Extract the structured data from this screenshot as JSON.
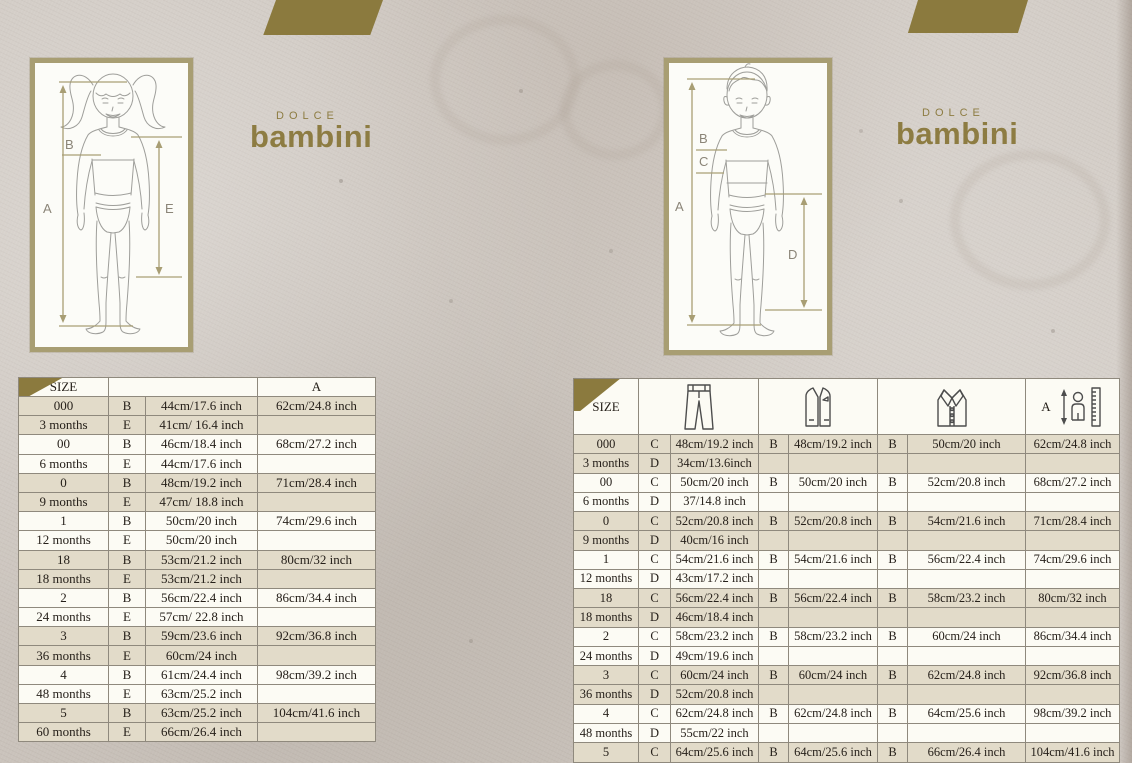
{
  "brand": {
    "dolce": "DOLCE",
    "bambini": "bambini"
  },
  "colors": {
    "gold_decoration": "#8b7a3e",
    "logo_gold": "#8d7c42",
    "row_beige": "#e2dbc9",
    "row_white": "#fcfbf4",
    "table_border": "#8f897d",
    "frame_tan": "#a89e73",
    "text": "#26201a",
    "background": "#cec7c0"
  },
  "girl_diagram": {
    "label_a": "A",
    "label_b": "B",
    "label_e": "E"
  },
  "boy_diagram": {
    "label_a": "A",
    "label_b": "B",
    "label_c": "C",
    "label_d": "D"
  },
  "left_table": {
    "header": {
      "size": "SIZE",
      "a": "A"
    },
    "rows": [
      [
        "000",
        "B",
        "44cm/17.6 inch",
        "62cm/24.8 inch"
      ],
      [
        "3 months",
        "E",
        "41cm/ 16.4 inch",
        ""
      ],
      [
        "00",
        "B",
        "46cm/18.4 inch",
        "68cm/27.2 inch"
      ],
      [
        "6 months",
        "E",
        "44cm/17.6 inch",
        ""
      ],
      [
        "0",
        "B",
        "48cm/19.2 inch",
        "71cm/28.4 inch"
      ],
      [
        "9 months",
        "E",
        "47cm/ 18.8 inch",
        ""
      ],
      [
        "1",
        "B",
        "50cm/20 inch",
        "74cm/29.6 inch"
      ],
      [
        "12 months",
        "E",
        "50cm/20 inch",
        ""
      ],
      [
        "18",
        "B",
        "53cm/21.2 inch",
        "80cm/32 inch"
      ],
      [
        "18 months",
        "E",
        "53cm/21.2 inch",
        ""
      ],
      [
        "2",
        "B",
        "56cm/22.4 inch",
        "86cm/34.4 inch"
      ],
      [
        "24 months",
        "E",
        "57cm/ 22.8 inch",
        ""
      ],
      [
        "3",
        "B",
        "59cm/23.6 inch",
        "92cm/36.8 inch"
      ],
      [
        "36 months",
        "E",
        "60cm/24 inch",
        ""
      ],
      [
        "4",
        "B",
        "61cm/24.4 inch",
        "98cm/39.2 inch"
      ],
      [
        "48 months",
        "E",
        "63cm/25.2 inch",
        ""
      ],
      [
        "5",
        "B",
        "63cm/25.2 inch",
        "104cm/41.6 inch"
      ],
      [
        "60 months",
        "E",
        "66cm/26.4 inch",
        ""
      ]
    ]
  },
  "right_table": {
    "header": {
      "size": "SIZE",
      "a": "A",
      "icons": [
        "pants-icon",
        "vest-icon",
        "shirt-icon",
        "height-ruler-icon"
      ]
    },
    "rows": [
      [
        "000",
        "C",
        "48cm/19.2 inch",
        "B",
        "48cm/19.2 inch",
        "B",
        "50cm/20 inch",
        "62cm/24.8 inch"
      ],
      [
        "3 months",
        "D",
        "34cm/13.6inch",
        "",
        "",
        "",
        "",
        ""
      ],
      [
        "00",
        "C",
        "50cm/20 inch",
        "B",
        "50cm/20 inch",
        "B",
        "52cm/20.8 inch",
        "68cm/27.2 inch"
      ],
      [
        "6 months",
        "D",
        "37/14.8 inch",
        "",
        "",
        "",
        "",
        ""
      ],
      [
        "0",
        "C",
        "52cm/20.8 inch",
        "B",
        "52cm/20.8 inch",
        "B",
        "54cm/21.6 inch",
        "71cm/28.4 inch"
      ],
      [
        "9 months",
        "D",
        "40cm/16 inch",
        "",
        "",
        "",
        "",
        ""
      ],
      [
        "1",
        "C",
        "54cm/21.6 inch",
        "B",
        "54cm/21.6 inch",
        "B",
        "56cm/22.4 inch",
        "74cm/29.6 inch"
      ],
      [
        "12 months",
        "D",
        "43cm/17.2 inch",
        "",
        "",
        "",
        "",
        ""
      ],
      [
        "18",
        "C",
        "56cm/22.4 inch",
        "B",
        "56cm/22.4 inch",
        "B",
        "58cm/23.2 inch",
        "80cm/32 inch"
      ],
      [
        "18 months",
        "D",
        "46cm/18.4 inch",
        "",
        "",
        "",
        "",
        ""
      ],
      [
        "2",
        "C",
        "58cm/23.2 inch",
        "B",
        "58cm/23.2 inch",
        "B",
        "60cm/24 inch",
        "86cm/34.4 inch"
      ],
      [
        "24 months",
        "D",
        "49cm/19.6 inch",
        "",
        "",
        "",
        "",
        ""
      ],
      [
        "3",
        "C",
        "60cm/24 inch",
        "B",
        "60cm/24 inch",
        "B",
        "62cm/24.8 inch",
        "92cm/36.8 inch"
      ],
      [
        "36 months",
        "D",
        "52cm/20.8 inch",
        "",
        "",
        "",
        "",
        ""
      ],
      [
        "4",
        "C",
        "62cm/24.8 inch",
        "B",
        "62cm/24.8 inch",
        "B",
        "64cm/25.6 inch",
        "98cm/39.2 inch"
      ],
      [
        "48 months",
        "D",
        "55cm/22 inch",
        "",
        "",
        "",
        "",
        ""
      ],
      [
        "5",
        "C",
        "64cm/25.6 inch",
        "B",
        "64cm/25.6 inch",
        "B",
        "66cm/26.4 inch",
        "104cm/41.6 inch"
      ],
      [
        "60 months",
        "D",
        "58cm/23.2 inch",
        "",
        "",
        "",
        "",
        ""
      ]
    ]
  }
}
